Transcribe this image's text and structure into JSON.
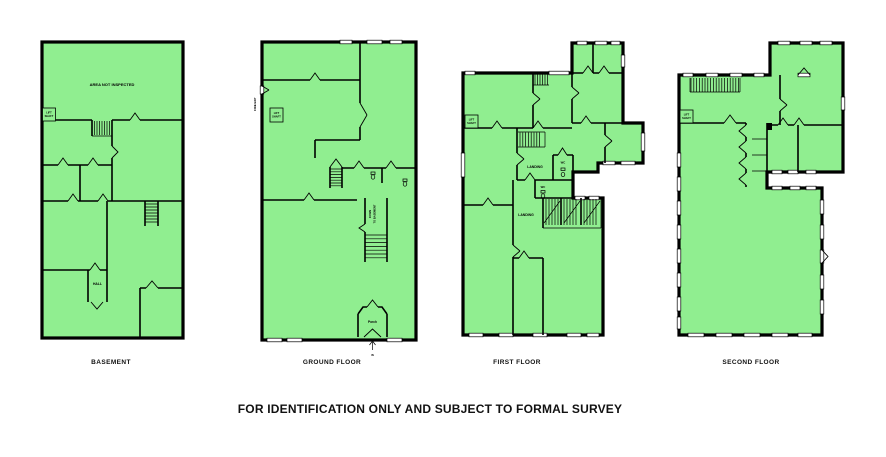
{
  "document_title": "FOR IDENTIFICATION ONLY AND SUBJECT TO FORMAL SURVEY",
  "colors": {
    "plan_fill": "#90EE90",
    "wall": "#000000",
    "background": "#FFFFFF"
  },
  "floors": {
    "basement": {
      "caption": "BASEMENT",
      "labels": {
        "area_not_inspected": "AREA NOT INSPECTED",
        "lift": "LIFT",
        "shaft": "SHAFT",
        "hall": "HALL"
      }
    },
    "ground": {
      "caption": "GROUND FLOOR",
      "labels": {
        "fire_exit": "FIRE EXIT",
        "lift": "LIFT",
        "shaft": "SHAFT",
        "down": "DOWN",
        "to_basement": "TO BASEMENT",
        "porch": "Porch",
        "entrance": "IN"
      }
    },
    "first": {
      "caption": "FIRST FLOOR",
      "labels": {
        "lift": "LIFT",
        "shaft": "SHAFT",
        "landing_upper": "LANDING",
        "landing_lower": "LANDING",
        "wc_upper": "WC",
        "wc_lower": "WC"
      }
    },
    "second": {
      "caption": "SECOND FLOOR",
      "labels": {
        "lift": "LIFT",
        "shaft": "SHAFT"
      }
    }
  }
}
